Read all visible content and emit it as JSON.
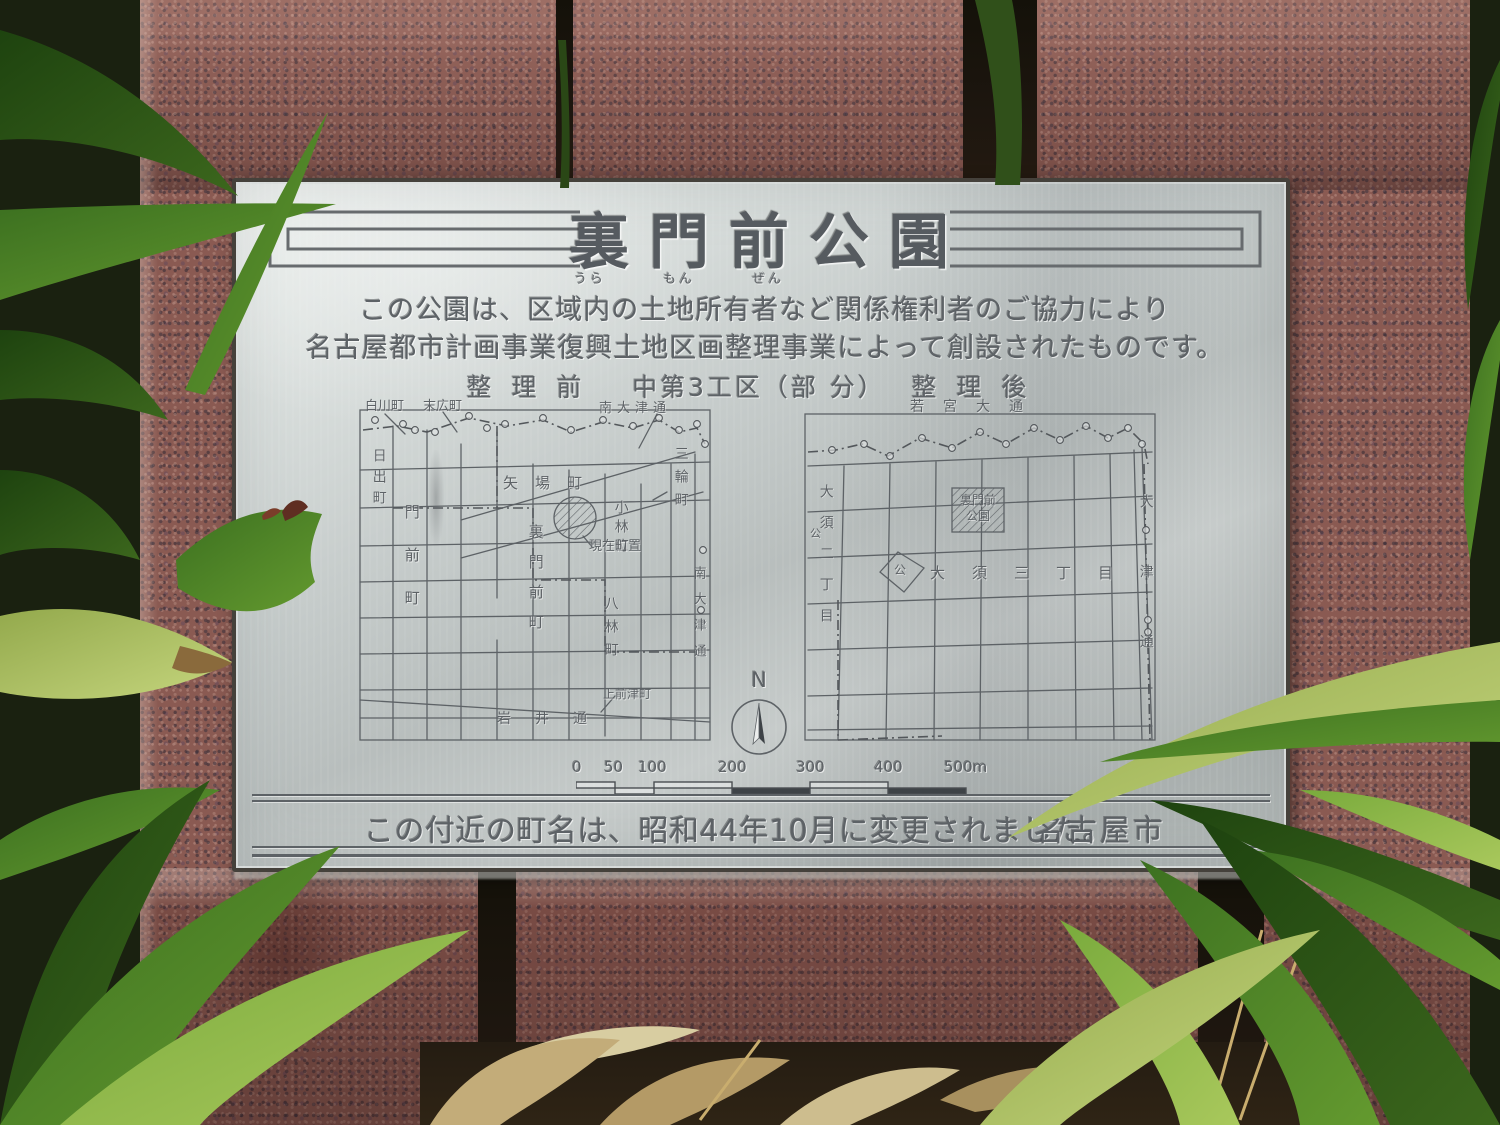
{
  "plaque": {
    "title": "裏門前公園",
    "furigana": "うら もん ぜん",
    "intro": [
      "この公園は、区域内の土地所有者など関係権利者のご協力により",
      "名古屋都市計画事業復興土地区画整理事業によって創設されたものです。"
    ],
    "sections": {
      "before": "整理前",
      "district": "中第3工区（部 分）",
      "after": "整理後"
    },
    "compass_label": "N",
    "scale": {
      "ticks": [
        "0",
        "50",
        "100",
        "200",
        "300",
        "400",
        "500m"
      ]
    },
    "footer": {
      "note": "この付近の町名は、昭和44年10月に変更されました。",
      "city": "名古屋市"
    }
  },
  "maps": {
    "before": {
      "labels": {
        "shirakawa": "白川町",
        "suehiro": "末広町",
        "minami_otsu_top": "南大津通",
        "hinode": "日出町",
        "monzen": "門前町",
        "yaba": "矢場町",
        "current_location": "現在位置",
        "kobayashi": "小林町",
        "miwa": "三輪町",
        "uramonzen": "裏門前町",
        "hachibayashi": "八林町",
        "minami_otsu_right": "南大津通",
        "iwai": "岩井通",
        "kamimaezu": "上前津町"
      }
    },
    "after": {
      "labels": {
        "wakamiya": "若宮大通",
        "park_line1": "裏門前",
        "park_line2": "公園",
        "osu_2chome": "大須二丁目",
        "osu_3chome": "大須三丁目",
        "otsu_dori": "大津通",
        "park_symbol_center": "公",
        "park_symbol_left": "公"
      }
    }
  },
  "colors": {
    "granite": "#8a5a52",
    "plaque_silver": "#c6cccb",
    "engraving": "#5d6266",
    "leaf_green": "#4e7d22",
    "dead_leaf": "#c3ac79"
  }
}
